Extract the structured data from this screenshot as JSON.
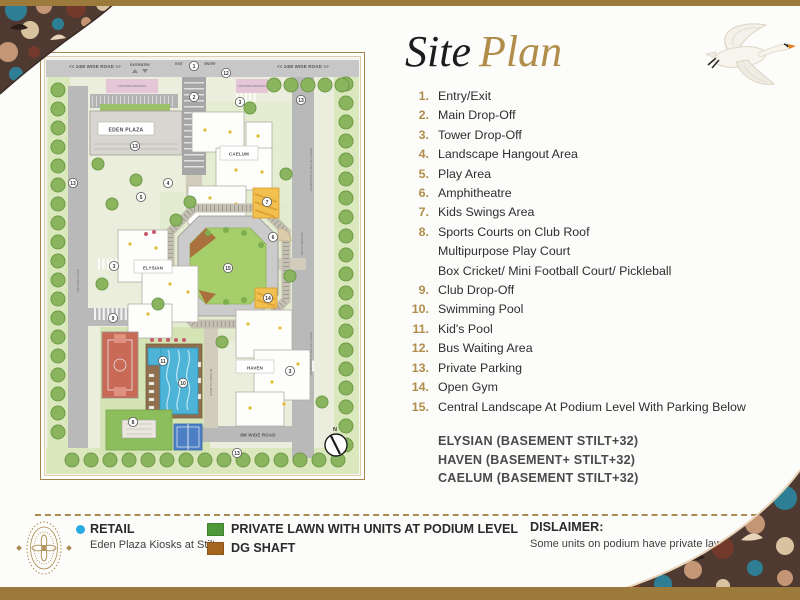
{
  "title": {
    "word1": "Site",
    "word2": "Plan"
  },
  "accent_gold": "#b08d4a",
  "legend_list": {
    "items": [
      {
        "n": "1.",
        "label": "Entry/Exit"
      },
      {
        "n": "2.",
        "label": "Main Drop-Off"
      },
      {
        "n": "3.",
        "label": "Tower Drop-Off"
      },
      {
        "n": "4.",
        "label": "Landscape Hangout Area"
      },
      {
        "n": "5.",
        "label": "Play Area"
      },
      {
        "n": "6.",
        "label": "Amphitheatre"
      },
      {
        "n": "7.",
        "label": "Kids Swings Area"
      },
      {
        "n": "8.",
        "label": "Sports Courts on Club Roof",
        "sub": [
          "Multipurpose Play Court",
          "Box Cricket/ Mini Football Court/ Pickleball"
        ]
      },
      {
        "n": "9.",
        "label": "Club Drop-Off"
      },
      {
        "n": "10.",
        "label": "Swimming Pool"
      },
      {
        "n": "11.",
        "label": "Kid's Pool"
      },
      {
        "n": "12.",
        "label": "Bus Waiting Area"
      },
      {
        "n": "13.",
        "label": "Private Parking"
      },
      {
        "n": "14.",
        "label": "Open Gym"
      },
      {
        "n": "15.",
        "label": "Central Landscape At Podium Level With Parking Below"
      }
    ],
    "towers": [
      "ELYSIAN (BASEMENT STILT+32)",
      "HAVEN (BASEMENT+ STILT+32)",
      "CAELUM (BASEMENT STILT+32)"
    ]
  },
  "map": {
    "labels": {
      "road_top_left": "<<  24M WIDE ROAD  >>",
      "road_top_right": "<<  24M WIDE ROAD  >>",
      "exit_entry": "EXIT/ENTRY",
      "exit": "EXIT",
      "entry": "ENTRY",
      "visitors_parking": "VISITORS PARKING",
      "eden_plaza": "EDEN PLAZA",
      "caelum": "CAELUM",
      "elysian": "ELYSIAN",
      "haven": "HAVEN",
      "road_left": "6M WIDE ROAD",
      "road_right": "6M WIDE ROAD",
      "road_bottom": "8M WIDE ROAD",
      "ramp": "RAMP TO PODIUM",
      "stilt_entry": "ENTRY TO STILT/ BASEMENT",
      "north": "N"
    },
    "markers": [
      {
        "n": "1",
        "x": 154,
        "y": 14
      },
      {
        "n": "12",
        "x": 186,
        "y": 21
      },
      {
        "n": "2",
        "x": 154,
        "y": 45
      },
      {
        "n": "3",
        "x": 200,
        "y": 50
      },
      {
        "n": "13",
        "x": 261,
        "y": 48
      },
      {
        "n": "13",
        "x": 95,
        "y": 94
      },
      {
        "n": "13",
        "x": 33,
        "y": 131
      },
      {
        "n": "4",
        "x": 128,
        "y": 131
      },
      {
        "n": "5",
        "x": 101,
        "y": 145
      },
      {
        "n": "7",
        "x": 227,
        "y": 150
      },
      {
        "n": "6",
        "x": 233,
        "y": 185
      },
      {
        "n": "15",
        "x": 188,
        "y": 216
      },
      {
        "n": "3",
        "x": 74,
        "y": 214
      },
      {
        "n": "14",
        "x": 228,
        "y": 246
      },
      {
        "n": "9",
        "x": 73,
        "y": 266
      },
      {
        "n": "11",
        "x": 123,
        "y": 309
      },
      {
        "n": "10",
        "x": 143,
        "y": 331
      },
      {
        "n": "3",
        "x": 250,
        "y": 319
      },
      {
        "n": "8",
        "x": 93,
        "y": 370
      },
      {
        "n": "13",
        "x": 197,
        "y": 401
      }
    ]
  },
  "footer": {
    "retail_label": "RETAIL",
    "retail_sub": "Eden Plaza Kiosks at Stilt",
    "retail_dot_color": "#29abe2",
    "lawn_label": "PRIVATE LAWN WITH UNITS AT PODIUM LEVEL",
    "lawn_color": "#4e9939",
    "dg_label": "DG SHAFT",
    "dg_color": "#a5661f",
    "disclaimer_title": "DISLAIMER:",
    "disclaimer_text": "Some units on podium have private lawns"
  }
}
